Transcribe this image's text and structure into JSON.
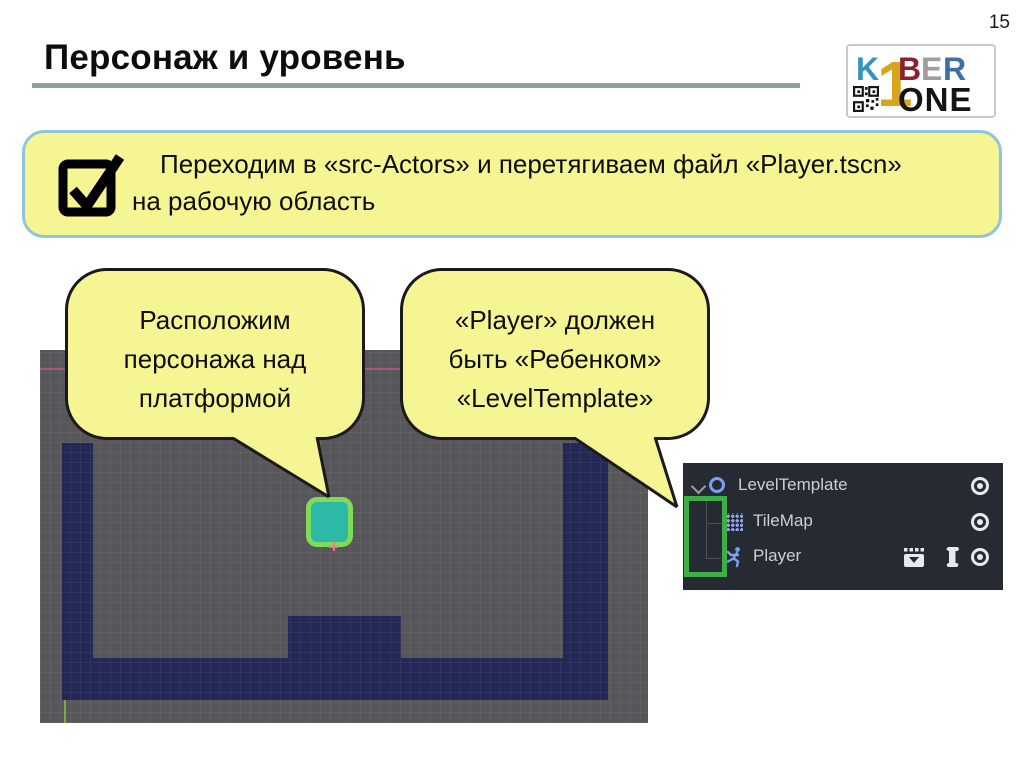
{
  "page": {
    "number": "15"
  },
  "header": {
    "title": "Персонаж и уровень"
  },
  "logo": {
    "k": "K",
    "digit": "1",
    "b": "B",
    "e": "E",
    "r": "R",
    "one": "ONE",
    "qr_icon": "qr-code-icon",
    "colors": {
      "k": "#3893bc",
      "digit": "#d9a41e",
      "b": "#8b2030",
      "e": "#9e9e9e",
      "r": "#3c70a8",
      "one": "#141414"
    }
  },
  "instruction": {
    "icon": "checkbox-check-icon",
    "line1": "Переходим в «src-Actors» и перетягиваем файл «Player.tscn»",
    "line2": "на рабочую область"
  },
  "bubbles": {
    "left": {
      "line1": "Расположим",
      "line2": "персонажа над",
      "line3": "платформой"
    },
    "right": {
      "line1": "«Player» должен",
      "line2": "быть «Ребенком»",
      "line3": "«LevelTemplate»"
    }
  },
  "scene_tree": {
    "rows": [
      {
        "label": "LevelTemplate",
        "icon": "node2d-icon",
        "expanded": true,
        "right_icons": [
          "eye-icon"
        ]
      },
      {
        "label": "TileMap",
        "icon": "tilemap-icon",
        "right_icons": [
          "eye-icon"
        ]
      },
      {
        "label": "Player",
        "icon": "kinematicbody2d-icon",
        "right_icons": [
          "instanced-scene-icon",
          "script-icon",
          "eye-icon"
        ]
      }
    ]
  },
  "colors": {
    "callout_fill": "#f6f593",
    "callout_border": "#8fc4dc",
    "title_underline": "#8da1a1",
    "viewport_gray": "#57575b",
    "tile_navy": "#232857",
    "player_fill": "#2cb9a6",
    "player_outline": "#81db58",
    "origin_cross": "#e87c96",
    "panel_bg": "#252a33",
    "panel_text": "#cbd0d8",
    "node_icon_blue": "#7c9ff0",
    "highlight_green": "#3eae46"
  }
}
